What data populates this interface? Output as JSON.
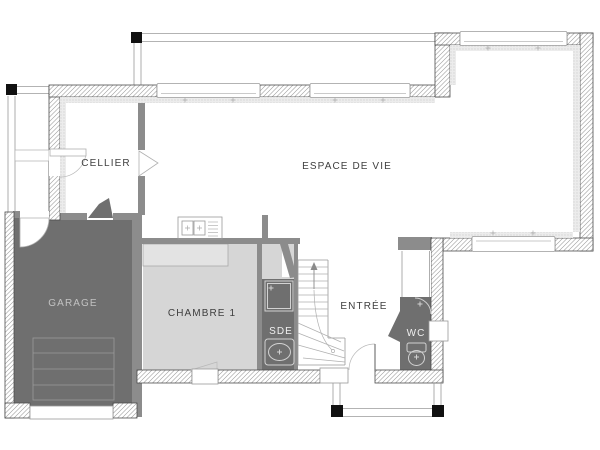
{
  "plan": {
    "rooms": {
      "cellier": {
        "label": "CELLIER"
      },
      "espace_de_vie": {
        "label": "ESPACE DE VIE"
      },
      "garage": {
        "label": "GARAGE"
      },
      "chambre_1": {
        "label": "CHAMBRE 1"
      },
      "sde": {
        "label": "SDE"
      },
      "entree": {
        "label": "ENTRÉE"
      },
      "wc": {
        "label": "WC"
      }
    },
    "colors": {
      "background": "#ffffff",
      "dark_room_fill": "#6f6f6f",
      "light_room_fill": "#d6d6d6",
      "closet_fill": "#e3e3e3",
      "partition_wall": "#8c8c8c",
      "wall_outline": "#4d4d4d",
      "hatch_line": "#999999",
      "thin_line": "#9a9a9a",
      "fixture_line": "#d2d2d2",
      "label_dark": "#3e3e3e",
      "label_on_garage": "#c2c2c2",
      "label_on_dark": "#f0f0f0",
      "post_black": "#111111"
    }
  }
}
